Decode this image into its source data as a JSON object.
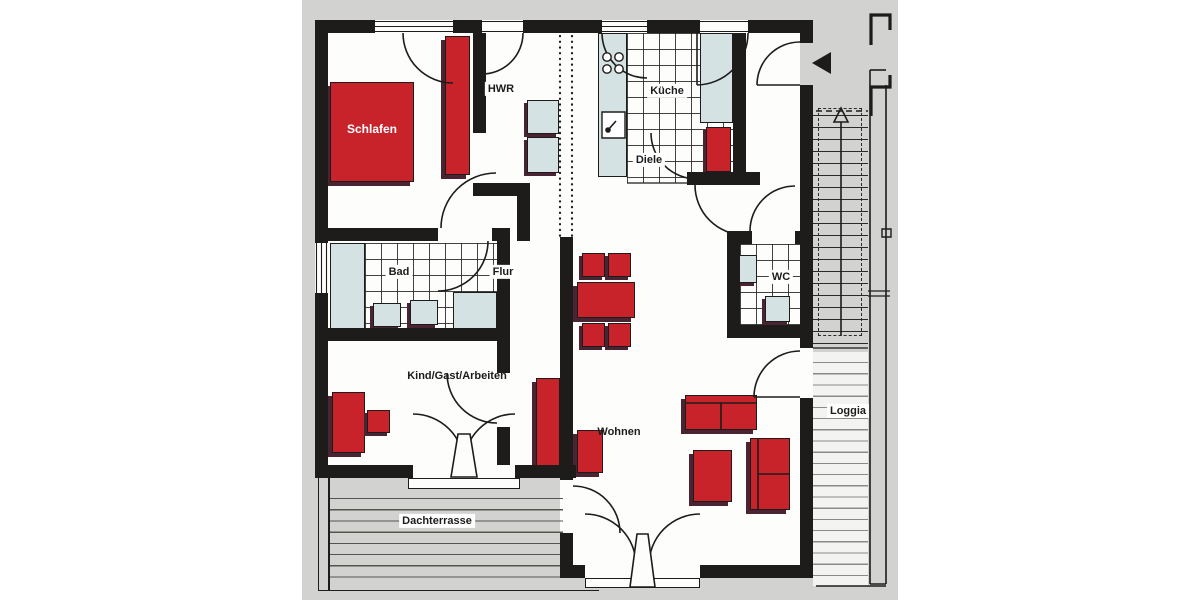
{
  "plan": {
    "rooms": [
      {
        "id": "schlafen",
        "label": "Schlafen"
      },
      {
        "id": "hwr",
        "label": "HWR"
      },
      {
        "id": "kueche",
        "label": "Küche"
      },
      {
        "id": "diele",
        "label": "Diele"
      },
      {
        "id": "bad",
        "label": "Bad"
      },
      {
        "id": "flur",
        "label": "Flur"
      },
      {
        "id": "wc",
        "label": "WC"
      },
      {
        "id": "kind-gast-arbeiten",
        "label": "Kind/Gast/Arbeiten"
      },
      {
        "id": "wohnen",
        "label": "Wohnen"
      },
      {
        "id": "loggia",
        "label": "Loggia"
      },
      {
        "id": "dachterrasse",
        "label": "Dachterrasse"
      }
    ],
    "furniture": [
      "bed",
      "wardrobe",
      "entry-cabinet",
      "dining-table",
      "dining-chairs-4",
      "sofa-two-seat",
      "sofa-single",
      "side-table",
      "desk",
      "desk-chair",
      "hall-wardrobe",
      "living-cabinet"
    ],
    "fixtures": [
      "kitchen-counter",
      "hob",
      "kitchen-sink",
      "tall-cabinet",
      "washer",
      "dryer",
      "bathtub",
      "bath-sink-1",
      "bath-sink-2",
      "shower",
      "wc-sink",
      "toilet"
    ],
    "symbols": {
      "entrance_arrow": "left-triangle",
      "stairs_direction": "up"
    },
    "colors": {
      "furniture_red": "#c8232b",
      "furniture_shadow": "#4b2434",
      "fixture_blue": "#d4e2e3",
      "wall_black": "#1d1c1a",
      "plan_background": "#d2d2d1",
      "page_background": "#ffffff"
    }
  }
}
